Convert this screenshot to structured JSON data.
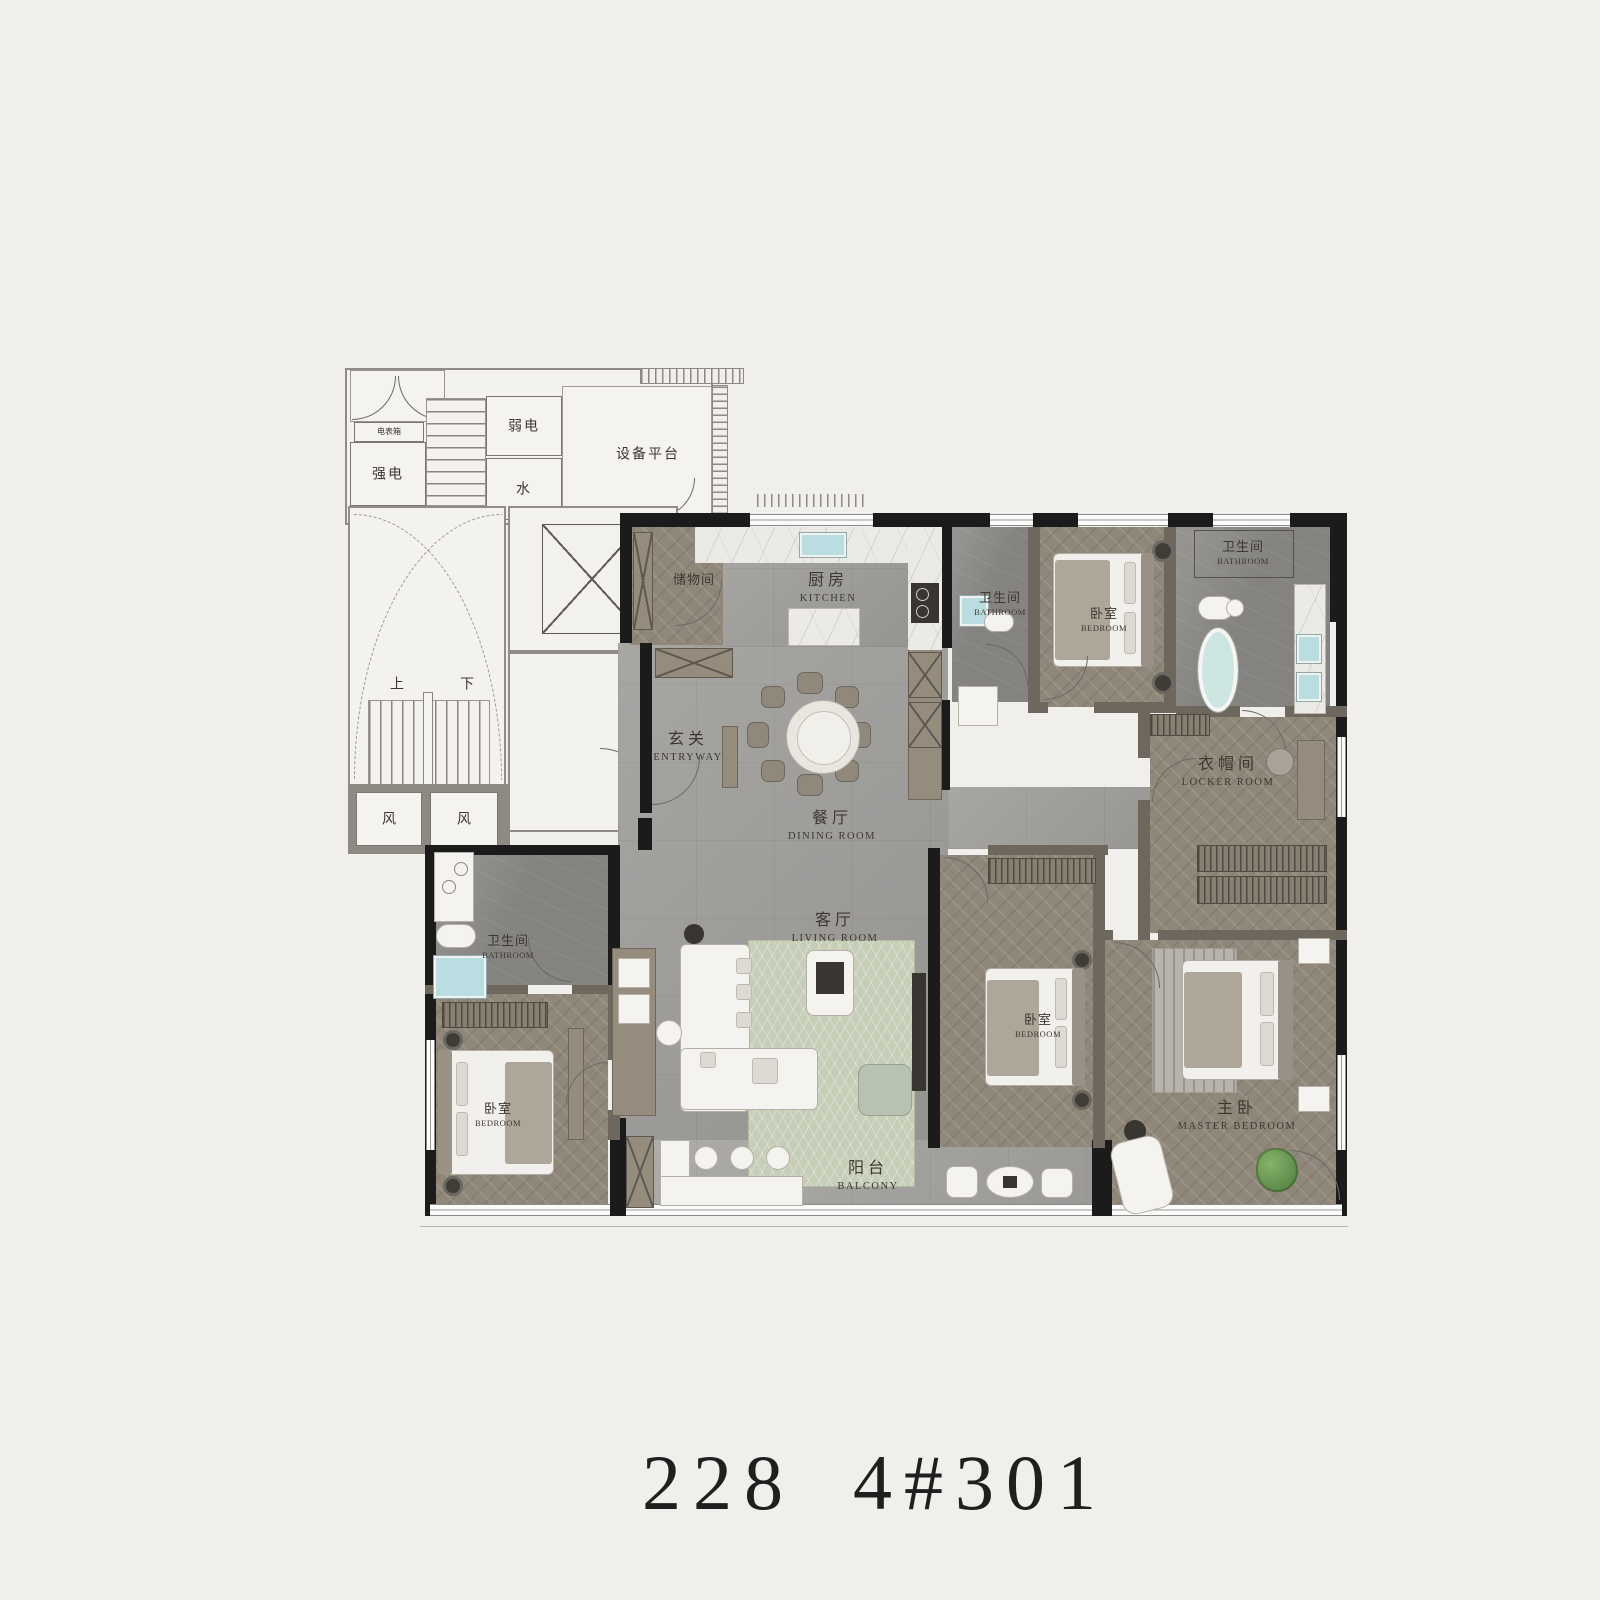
{
  "title": {
    "area": "228",
    "unit": "4#301"
  },
  "palette": {
    "background": "#f0efec",
    "wall_dark": "#1b1b1b",
    "wall_gray": "#8d8983",
    "wall_taupe": "#6e675d",
    "floor_wood": "#8f8779",
    "floor_stone": "#9d9c99",
    "floor_bath": "#84837f",
    "floor_marble": "#eceae6",
    "rug_green": "#c7ceb7",
    "water_blue": "#b9dde0"
  },
  "rooms": {
    "meter_box": {
      "zh": "电表箱"
    },
    "strong_elec": {
      "zh": "强电"
    },
    "weak_elec": {
      "zh": "弱电"
    },
    "water": {
      "zh": "水"
    },
    "equipment_platform": {
      "zh": "设备平台"
    },
    "stair_up": {
      "zh": "上"
    },
    "stair_down": {
      "zh": "下"
    },
    "vent_left": {
      "zh": "风"
    },
    "vent_right": {
      "zh": "风"
    },
    "storage": {
      "zh": "储物间"
    },
    "kitchen": {
      "zh": "厨房",
      "en": "KITCHEN"
    },
    "bath_mid": {
      "zh": "卫生间",
      "en": "BATHROOM"
    },
    "bed_top": {
      "zh": "卧室",
      "en": "BEDROOM"
    },
    "bath_right": {
      "zh": "卫生间",
      "en": "BATHROOM"
    },
    "locker": {
      "zh": "衣帽间",
      "en": "LOCKER ROOM"
    },
    "entryway": {
      "zh": "玄关",
      "en": "ENTRYWAY"
    },
    "dining": {
      "zh": "餐厅",
      "en": "DINING ROOM"
    },
    "living": {
      "zh": "客厅",
      "en": "LIVING ROOM"
    },
    "bath_left": {
      "zh": "卫生间",
      "en": "BATHROOM"
    },
    "bed_left": {
      "zh": "卧室",
      "en": "BEDROOM"
    },
    "bed_mid": {
      "zh": "卧室",
      "en": "BEDROOM"
    },
    "master": {
      "zh": "主卧",
      "en": "MASTER BEDROOM"
    },
    "balcony": {
      "zh": "阳台",
      "en": "BALCONY"
    }
  }
}
